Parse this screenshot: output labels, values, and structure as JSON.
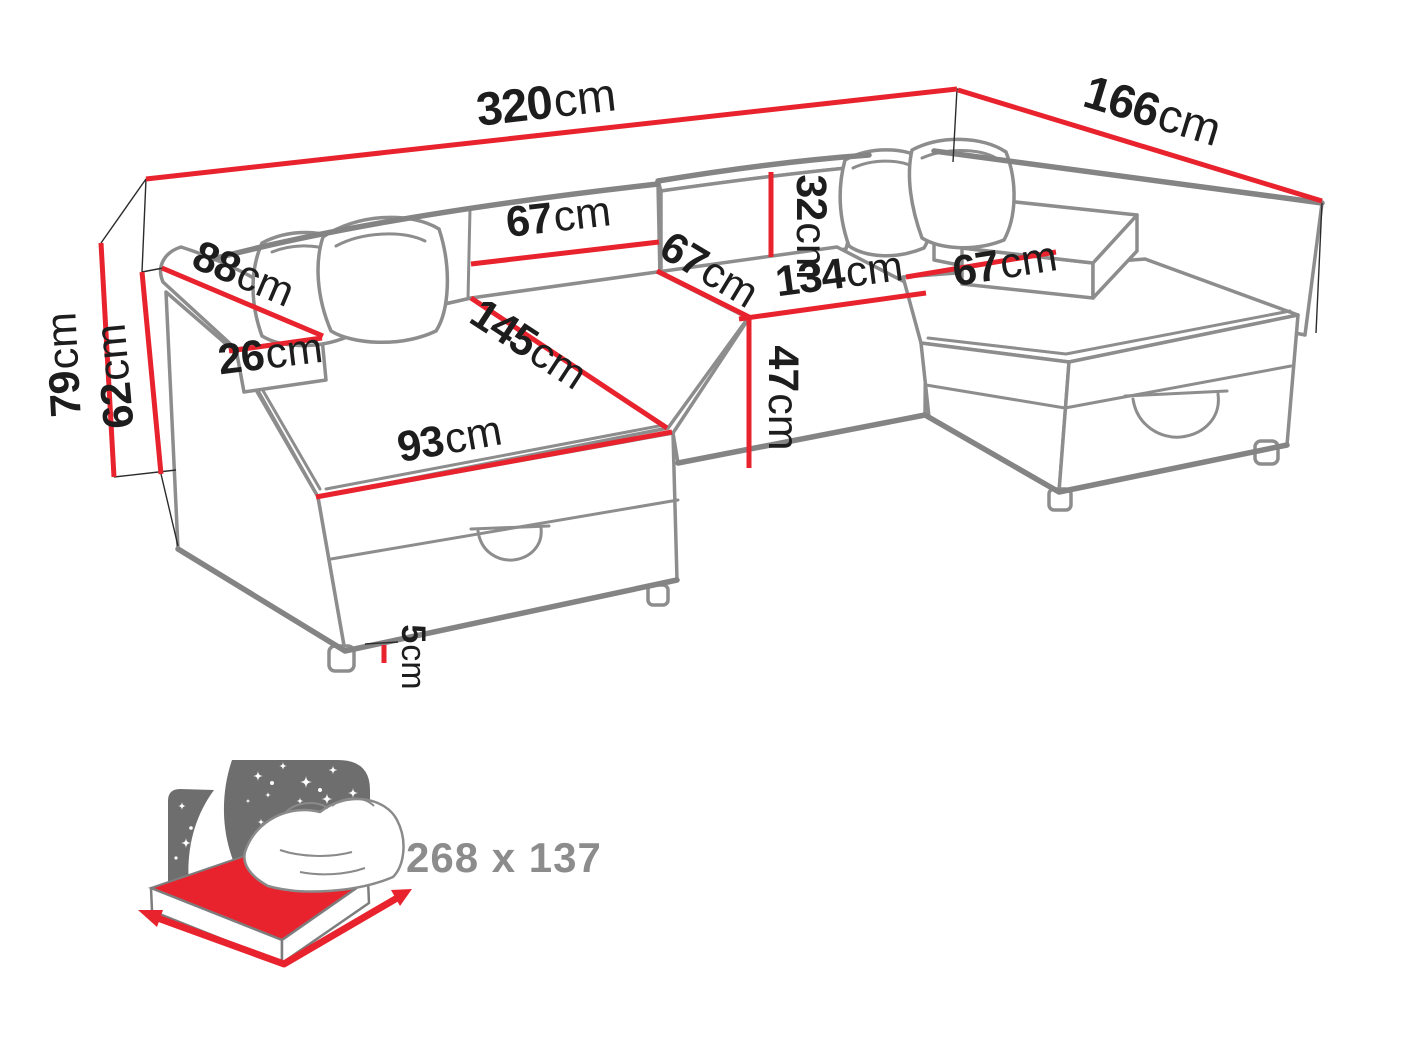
{
  "diagram": {
    "kind": "sofa-dimension-diagram",
    "unit": "cm"
  },
  "colors": {
    "dimension_red": "#e8232e",
    "outline_gray": "#8d8d8d",
    "wireframe_black": "#2b2b2b",
    "label_black": "#1d1d1d",
    "icon_gray": "#6e6e6e",
    "icon_text_gray": "#8c8c8c"
  },
  "dimensions": {
    "total_width": {
      "num": "320",
      "unit": "cm"
    },
    "total_depth": {
      "num": "166",
      "unit": "cm"
    },
    "total_height": {
      "num": "79",
      "unit": "cm"
    },
    "side_height": {
      "num": "62",
      "unit": "cm"
    },
    "armrest_length": {
      "num": "88",
      "unit": "cm"
    },
    "armrest_width": {
      "num": "26",
      "unit": "cm"
    },
    "backrest_width": {
      "num": "67",
      "unit": "cm"
    },
    "backrest_height": {
      "num": "32",
      "unit": "cm"
    },
    "seat_depth": {
      "num": "67",
      "unit": "cm"
    },
    "middle_seat_width": {
      "num": "134",
      "unit": "cm"
    },
    "right_chaise_width": {
      "num": "67",
      "unit": "cm"
    },
    "front_height": {
      "num": "47",
      "unit": "cm"
    },
    "chaise_length": {
      "num": "145",
      "unit": "cm"
    },
    "chaise_width": {
      "num": "93",
      "unit": "cm"
    },
    "leg_height": {
      "num": "5",
      "unit": "cm"
    }
  },
  "sleeping_area": {
    "size_label": "268 x 137"
  }
}
